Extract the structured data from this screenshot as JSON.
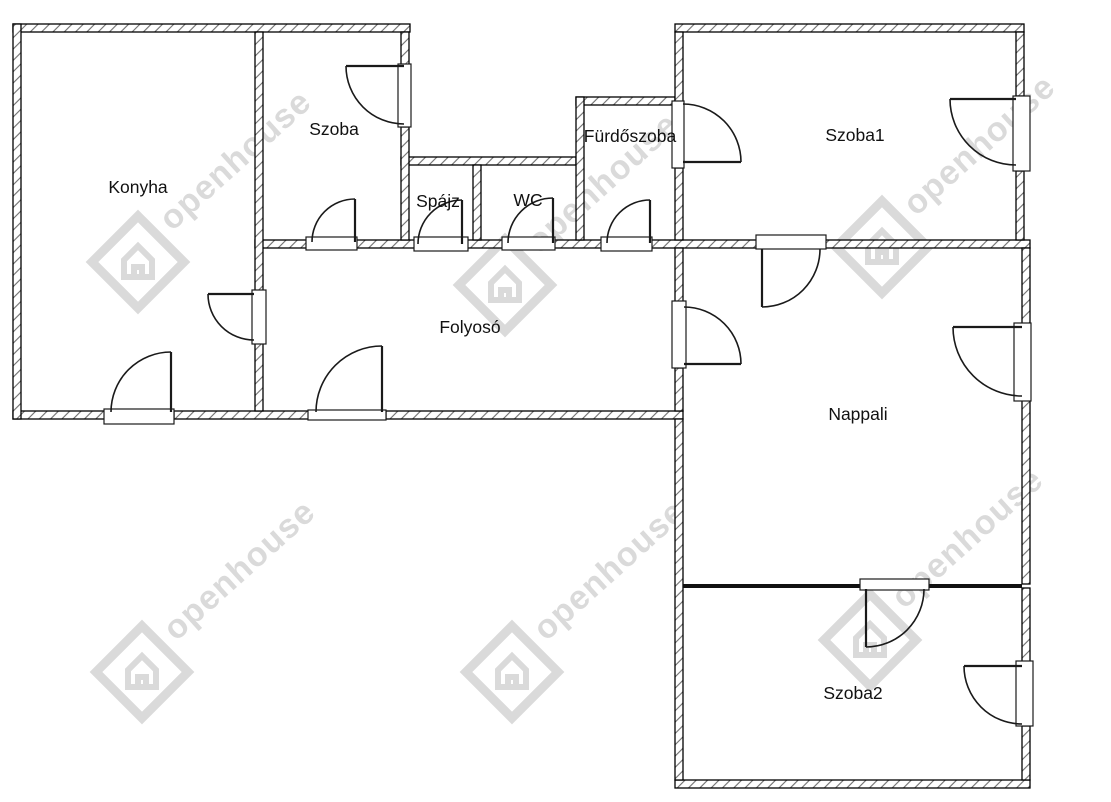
{
  "canvas": {
    "width": 1111,
    "height": 802
  },
  "colors": {
    "background": "#ffffff",
    "wall_border": "#000000",
    "hatch_line": "#6e6e6e",
    "door_line": "#1a1a1a",
    "label_text": "#111111",
    "partition": "#111111",
    "watermark": "#bcbcbc"
  },
  "floorplan": {
    "rooms": [
      {
        "id": "konyha",
        "label": "Konyha",
        "label_x": 138,
        "label_y": 193
      },
      {
        "id": "szoba",
        "label": "Szoba",
        "label_x": 334,
        "label_y": 135
      },
      {
        "id": "spajz",
        "label": "Spájz",
        "label_x": 438,
        "label_y": 207
      },
      {
        "id": "wc",
        "label": "WC",
        "label_x": 528,
        "label_y": 206
      },
      {
        "id": "furdoszoba",
        "label": "Fürdőszoba",
        "label_x": 630,
        "label_y": 142
      },
      {
        "id": "szoba1",
        "label": "Szoba1",
        "label_x": 855,
        "label_y": 141
      },
      {
        "id": "folyoso",
        "label": "Folyosó",
        "label_x": 470,
        "label_y": 333
      },
      {
        "id": "nappali",
        "label": "Nappali",
        "label_x": 858,
        "label_y": 420
      },
      {
        "id": "szoba2",
        "label": "Szoba2",
        "label_x": 853,
        "label_y": 699
      }
    ],
    "hatched_walls": [
      {
        "n": "wall-top-konyha-szoba",
        "x": 13,
        "y": 24,
        "w": 397,
        "h": 8
      },
      {
        "n": "wall-top-szoba1",
        "x": 675,
        "y": 24,
        "w": 349,
        "h": 8
      },
      {
        "n": "wall-top-spajz-wc",
        "x": 401,
        "y": 157,
        "w": 175,
        "h": 8
      },
      {
        "n": "wall-top-furdoszoba",
        "x": 576,
        "y": 97,
        "w": 99,
        "h": 8
      },
      {
        "n": "wall-folyoso-top-a",
        "x": 255,
        "y": 240,
        "w": 53,
        "h": 8
      },
      {
        "n": "wall-folyoso-top-b",
        "x": 356,
        "y": 240,
        "w": 60,
        "h": 8
      },
      {
        "n": "wall-folyoso-top-c",
        "x": 467,
        "y": 240,
        "w": 37,
        "h": 8
      },
      {
        "n": "wall-folyoso-top-d",
        "x": 554,
        "y": 240,
        "w": 49,
        "h": 8
      },
      {
        "n": "wall-folyoso-top-e",
        "x": 651,
        "y": 240,
        "w": 107,
        "h": 8
      },
      {
        "n": "wall-szoba1-nappali",
        "x": 825,
        "y": 240,
        "w": 205,
        "h": 8
      },
      {
        "n": "wall-bottom-konyha-a",
        "x": 13,
        "y": 411,
        "w": 92,
        "h": 8
      },
      {
        "n": "wall-bottom-konyha-b",
        "x": 174,
        "y": 411,
        "w": 135,
        "h": 8
      },
      {
        "n": "wall-bottom-folyoso",
        "x": 386,
        "y": 411,
        "w": 297,
        "h": 8
      },
      {
        "n": "wall-bottom-szoba2",
        "x": 675,
        "y": 780,
        "w": 355,
        "h": 8
      },
      {
        "n": "wall-left-konyha",
        "x": 13,
        "y": 24,
        "w": 8,
        "h": 395
      },
      {
        "n": "wall-konyha-szoba-a",
        "x": 255,
        "y": 32,
        "w": 8,
        "h": 259
      },
      {
        "n": "wall-konyha-folyoso-b",
        "x": 255,
        "y": 343,
        "w": 8,
        "h": 68
      },
      {
        "n": "wall-szoba-spajz-a",
        "x": 401,
        "y": 32,
        "w": 8,
        "h": 33
      },
      {
        "n": "wall-szoba-spajz-b",
        "x": 401,
        "y": 127,
        "w": 8,
        "h": 113
      },
      {
        "n": "wall-spajz-wc",
        "x": 473,
        "y": 165,
        "w": 8,
        "h": 75
      },
      {
        "n": "wall-wc-furdoszoba",
        "x": 576,
        "y": 97,
        "w": 8,
        "h": 143
      },
      {
        "n": "wall-furdoszoba-szoba1-a",
        "x": 675,
        "y": 32,
        "w": 8,
        "h": 70
      },
      {
        "n": "wall-furdoszoba-szoba1-b",
        "x": 675,
        "y": 168,
        "w": 8,
        "h": 72
      },
      {
        "n": "wall-folyoso-nappali-a",
        "x": 675,
        "y": 248,
        "w": 8,
        "h": 54
      },
      {
        "n": "wall-folyoso-nappali-b",
        "x": 675,
        "y": 368,
        "w": 8,
        "h": 43
      },
      {
        "n": "wall-left-nappali-szoba2",
        "x": 675,
        "y": 419,
        "w": 8,
        "h": 361
      },
      {
        "n": "wall-right-szoba1-a",
        "x": 1016,
        "y": 32,
        "w": 8,
        "h": 64
      },
      {
        "n": "wall-right-szoba1-b",
        "x": 1016,
        "y": 171,
        "w": 8,
        "h": 69
      },
      {
        "n": "wall-right-nappali-a",
        "x": 1022,
        "y": 248,
        "w": 8,
        "h": 76
      },
      {
        "n": "wall-right-nappali-b",
        "x": 1022,
        "y": 400,
        "w": 8,
        "h": 184
      },
      {
        "n": "wall-right-szoba2-a",
        "x": 1022,
        "y": 588,
        "w": 8,
        "h": 74
      },
      {
        "n": "wall-right-szoba2-b",
        "x": 1022,
        "y": 726,
        "w": 8,
        "h": 54
      }
    ],
    "solid_walls": [
      {
        "n": "partition-nappali-szoba2-a",
        "x": 683,
        "y": 584,
        "w": 179,
        "h": 4
      },
      {
        "n": "partition-nappali-szoba2-b",
        "x": 928,
        "y": 584,
        "w": 94,
        "h": 4
      }
    ],
    "openings": [
      {
        "n": "opening-szoba-east-door",
        "x": 398,
        "y": 64,
        "w": 13,
        "h": 63
      },
      {
        "n": "opening-furdoszoba-szoba1",
        "x": 672,
        "y": 101,
        "w": 12,
        "h": 67
      },
      {
        "n": "opening-szoba1-balcony-door",
        "x": 1013,
        "y": 96,
        "w": 17,
        "h": 75
      },
      {
        "n": "opening-konyha-folyoso-door",
        "x": 252,
        "y": 290,
        "w": 14,
        "h": 54
      },
      {
        "n": "opening-folyoso-nappali-door",
        "x": 672,
        "y": 301,
        "w": 14,
        "h": 67
      },
      {
        "n": "opening-nappali-balcony-door",
        "x": 1014,
        "y": 323,
        "w": 17,
        "h": 78
      },
      {
        "n": "opening-szoba2-balcony-door",
        "x": 1016,
        "y": 661,
        "w": 17,
        "h": 65
      },
      {
        "n": "opening-szoba-folyoso-door",
        "x": 306,
        "y": 237,
        "w": 51,
        "h": 13
      },
      {
        "n": "opening-spajz-door",
        "x": 414,
        "y": 237,
        "w": 54,
        "h": 14
      },
      {
        "n": "opening-wc-door",
        "x": 502,
        "y": 237,
        "w": 53,
        "h": 13
      },
      {
        "n": "opening-furdoszoba-door",
        "x": 601,
        "y": 237,
        "w": 51,
        "h": 14
      },
      {
        "n": "opening-szoba1-nappali-door",
        "x": 756,
        "y": 235,
        "w": 70,
        "h": 14
      },
      {
        "n": "opening-konyha-exterior-door",
        "x": 104,
        "y": 409,
        "w": 70,
        "h": 15
      },
      {
        "n": "opening-entrance-door",
        "x": 308,
        "y": 410,
        "w": 78,
        "h": 10
      },
      {
        "n": "opening-nappali-szoba2-door",
        "x": 860,
        "y": 579,
        "w": 69,
        "h": 11
      }
    ],
    "doors": [
      {
        "n": "door-szoba-east",
        "hinge": [
          404,
          66
        ],
        "tip": [
          346,
          66
        ],
        "end": [
          404,
          124
        ],
        "r": 58
      },
      {
        "n": "door-furdoszoba-szoba1",
        "hinge": [
          683,
          162
        ],
        "tip": [
          741,
          162
        ],
        "end": [
          683,
          104
        ],
        "r": 58
      },
      {
        "n": "door-szoba1-balcony",
        "hinge": [
          1016,
          99
        ],
        "tip": [
          950,
          99
        ],
        "end": [
          1016,
          165
        ],
        "r": 66
      },
      {
        "n": "door-konyha-folyoso",
        "hinge": [
          254,
          294
        ],
        "tip": [
          208,
          294
        ],
        "end": [
          254,
          340
        ],
        "r": 46
      },
      {
        "n": "door-folyoso-nappali",
        "hinge": [
          684,
          364
        ],
        "tip": [
          741,
          364
        ],
        "end": [
          684,
          307
        ],
        "r": 57
      },
      {
        "n": "door-nappali-balcony",
        "hinge": [
          1022,
          327
        ],
        "tip": [
          953,
          327
        ],
        "end": [
          1022,
          396
        ],
        "r": 69
      },
      {
        "n": "door-szoba2-balcony",
        "hinge": [
          1022,
          666
        ],
        "tip": [
          964,
          666
        ],
        "end": [
          1022,
          724
        ],
        "r": 58
      },
      {
        "n": "door-szoba-folyoso",
        "hinge": [
          355,
          242
        ],
        "tip": [
          355,
          199
        ],
        "end": [
          312,
          242
        ],
        "r": 43
      },
      {
        "n": "door-spajz",
        "hinge": [
          462,
          244
        ],
        "tip": [
          462,
          200
        ],
        "end": [
          418,
          244
        ],
        "r": 44
      },
      {
        "n": "door-wc",
        "hinge": [
          553,
          243
        ],
        "tip": [
          553,
          198
        ],
        "end": [
          508,
          243
        ],
        "r": 45
      },
      {
        "n": "door-furdoszoba",
        "hinge": [
          650,
          243
        ],
        "tip": [
          650,
          200
        ],
        "end": [
          607,
          243
        ],
        "r": 43
      },
      {
        "n": "door-szoba1-nappali",
        "hinge": [
          762,
          249
        ],
        "tip": [
          762,
          307
        ],
        "end": [
          820,
          249
        ],
        "r": 58
      },
      {
        "n": "door-konyha-exterior",
        "hinge": [
          171,
          412
        ],
        "tip": [
          171,
          352
        ],
        "end": [
          111,
          412
        ],
        "r": 60
      },
      {
        "n": "door-entrance",
        "hinge": [
          382,
          412
        ],
        "tip": [
          382,
          346
        ],
        "end": [
          316,
          412
        ],
        "r": 66
      },
      {
        "n": "door-nappali-szoba2",
        "hinge": [
          866,
          589
        ],
        "tip": [
          866,
          647
        ],
        "end": [
          924,
          589
        ],
        "r": 58
      }
    ]
  },
  "watermark": {
    "text": "openhouse",
    "instances": [
      {
        "x": 138,
        "y": 262
      },
      {
        "x": 505,
        "y": 285
      },
      {
        "x": 882,
        "y": 247
      },
      {
        "x": 142,
        "y": 672
      },
      {
        "x": 512,
        "y": 672
      },
      {
        "x": 870,
        "y": 640
      }
    ]
  }
}
